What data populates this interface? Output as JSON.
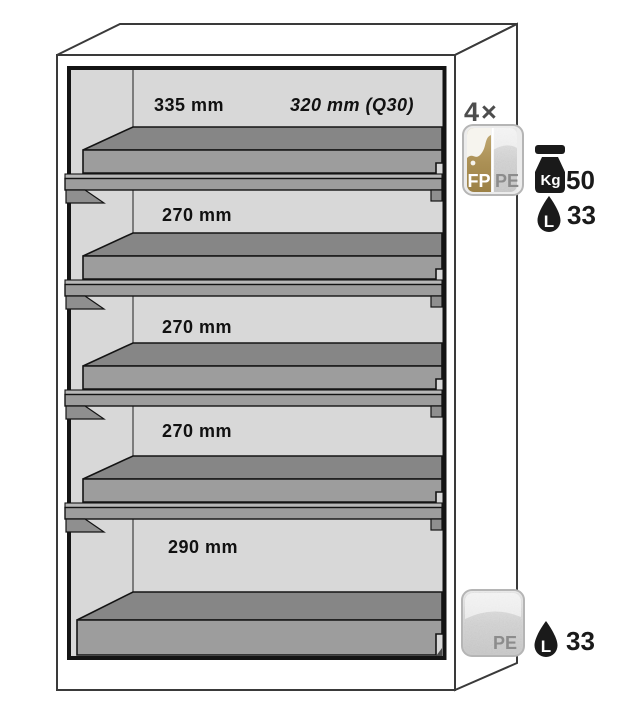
{
  "cabinet": {
    "sections": [
      {
        "depth_label": "335 mm",
        "alt_label": "320 mm (Q30)"
      },
      {
        "depth_label": "270 mm"
      },
      {
        "depth_label": "270 mm"
      },
      {
        "depth_label": "270 mm"
      },
      {
        "depth_label": "290 mm"
      }
    ],
    "shelf_count": 4
  },
  "shelf_annotation": {
    "quantity_label": "4×",
    "material_badge": {
      "left_label": "FP",
      "right_label": "PE"
    },
    "load_capacity": {
      "unit_label": "Kg",
      "value": "50"
    },
    "volume_capacity": {
      "unit_label": "L",
      "value": "33"
    }
  },
  "sump_annotation": {
    "material_badge": {
      "label": "PE"
    },
    "volume_capacity": {
      "unit_label": "L",
      "value": "33"
    }
  },
  "colors": {
    "interior_gray": "#d8d8d8",
    "shelf_top_gray": "#868686",
    "shelf_front_gray": "#9d9d9d",
    "rail_light_gray": "#b8b8b8",
    "outline": "#141414",
    "badge_gold": "#ab9055",
    "badge_gray": "#d6d6d6",
    "icon_black": "#1a1a1a",
    "quantity_gray": "#4d4d4d"
  }
}
